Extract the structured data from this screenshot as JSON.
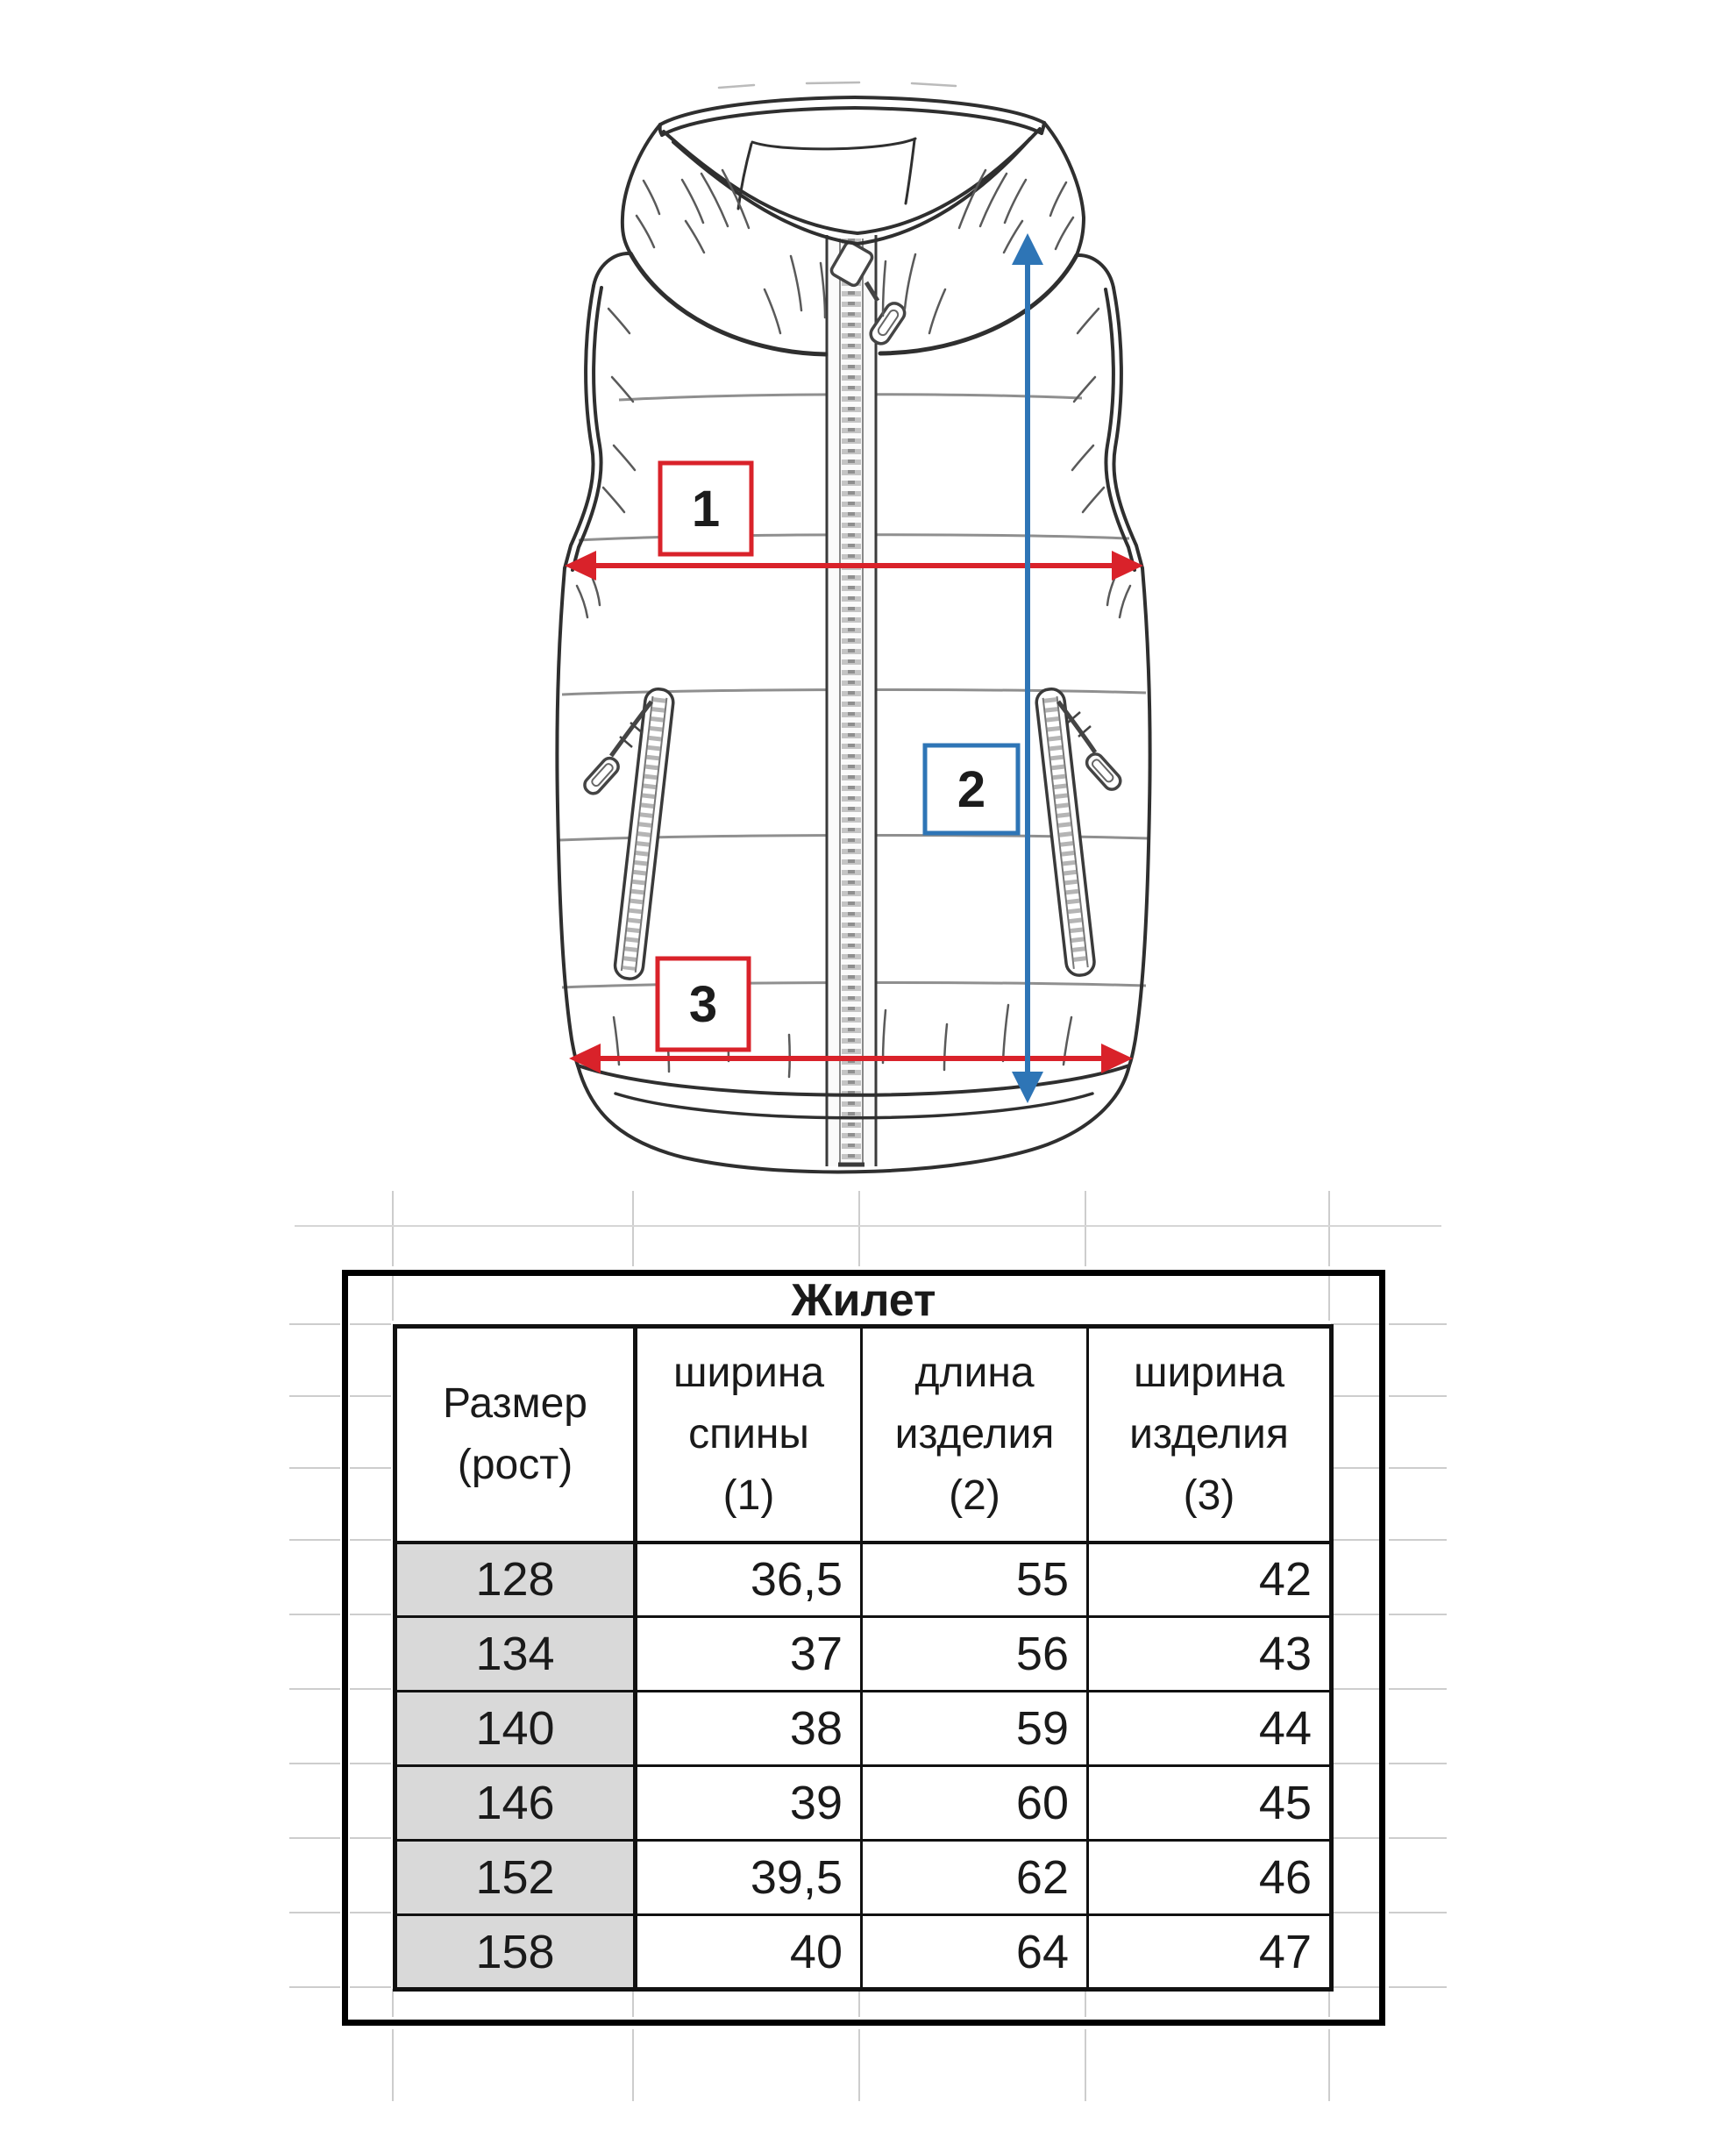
{
  "figure": {
    "markers": [
      {
        "label": "1",
        "color": "#d9222a"
      },
      {
        "label": "2",
        "color": "#2e75b6"
      },
      {
        "label": "3",
        "color": "#d9222a"
      }
    ],
    "colors": {
      "annotation_red": "#d9222a",
      "annotation_blue": "#2e75b6",
      "sketch_line": "#2f2f2f",
      "quilt_line": "#8f8f8f",
      "row_header_fill": "#d9d9d9",
      "gridline": "#cdcdcd"
    }
  },
  "table": {
    "title": "Жилет",
    "columns": [
      {
        "lines": [
          "Размер",
          "(рост)",
          ""
        ]
      },
      {
        "lines": [
          "ширина",
          "спины",
          "(1)"
        ]
      },
      {
        "lines": [
          "длина",
          "изделия",
          "(2)"
        ]
      },
      {
        "lines": [
          "ширина",
          "изделия",
          "(3)"
        ]
      }
    ],
    "rows": [
      {
        "size": "128",
        "values": [
          "36,5",
          "55",
          "42"
        ]
      },
      {
        "size": "134",
        "values": [
          "37",
          "56",
          "43"
        ]
      },
      {
        "size": "140",
        "values": [
          "38",
          "59",
          "44"
        ]
      },
      {
        "size": "146",
        "values": [
          "39",
          "60",
          "45"
        ]
      },
      {
        "size": "152",
        "values": [
          "39,5",
          "62",
          "46"
        ]
      },
      {
        "size": "158",
        "values": [
          "40",
          "64",
          "47"
        ]
      }
    ]
  }
}
